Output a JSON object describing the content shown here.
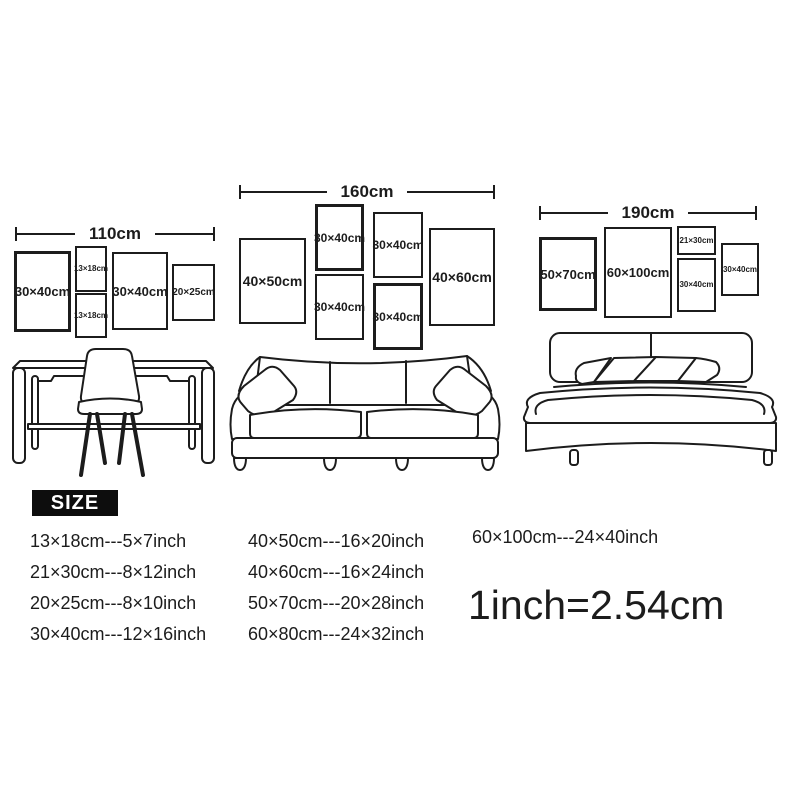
{
  "groups": [
    {
      "width_label": "110cm",
      "frames": [
        {
          "label": "30×40cm"
        },
        {
          "label": "13×18cm"
        },
        {
          "label": "13×18cm"
        },
        {
          "label": "30×40cm"
        },
        {
          "label": "20×25cm"
        }
      ]
    },
    {
      "width_label": "160cm",
      "frames": [
        {
          "label": "40×50cm"
        },
        {
          "label": "30×40cm"
        },
        {
          "label": "30×40cm"
        },
        {
          "label": "30×40cm"
        },
        {
          "label": "30×40cm"
        },
        {
          "label": "40×60cm"
        }
      ]
    },
    {
      "width_label": "190cm",
      "frames": [
        {
          "label": "50×70cm"
        },
        {
          "label": "60×100cm"
        },
        {
          "label": "21×30cm"
        },
        {
          "label": "30×40cm"
        },
        {
          "label": "30×40cm"
        }
      ]
    }
  ],
  "furniture": [
    {
      "name": "desk-with-chair"
    },
    {
      "name": "sofa"
    },
    {
      "name": "bed"
    }
  ],
  "size_legend": {
    "title": "SIZE",
    "columns": [
      [
        "13×18cm---5×7inch",
        "21×30cm---8×12inch",
        "20×25cm---8×10inch",
        "30×40cm---12×16inch"
      ],
      [
        "40×50cm---16×20inch",
        "40×60cm---16×24inch",
        "50×70cm---20×28inch",
        "60×80cm---24×32inch"
      ],
      [
        "60×100cm---24×40inch"
      ]
    ],
    "conversion": "1inch=2.54cm"
  },
  "colors": {
    "ink": "#1c1c1c",
    "background": "#ffffff",
    "badge_bg": "#0d0d0d",
    "badge_text": "#ffffff"
  }
}
